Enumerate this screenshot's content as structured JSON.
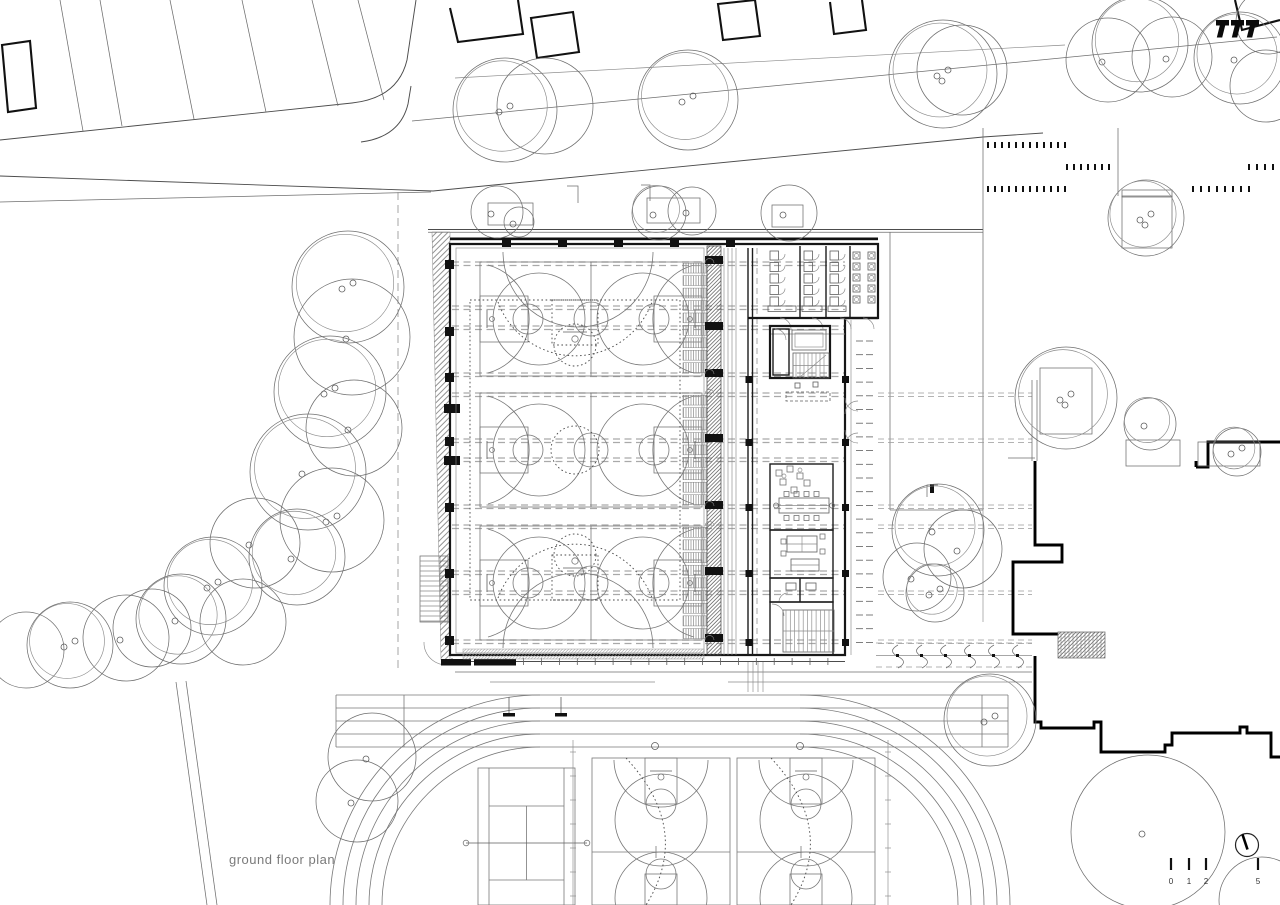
{
  "title": {
    "label": "ground floor plan"
  },
  "scale_bar": {
    "labels": [
      "0",
      "1",
      "2",
      "5"
    ],
    "unit_hint": "meters"
  },
  "compass": {
    "icon": "north-arrow"
  },
  "logo": {
    "icon": "architect-logo",
    "glyph_count": 3
  },
  "colors": {
    "paper": "#ffffff",
    "ink": "#1a1a1a",
    "ink_light": "#6e6e6e",
    "wall_poche": "#000000",
    "grid_dash": "#a9a9a9",
    "title_text": "#7a7a7a"
  },
  "plan": {
    "drawing_type": "architectural site plan",
    "level": "ground floor",
    "features": [
      "sports-hall",
      "indoor-basketball-courts",
      "show-court",
      "telescopic-bleachers",
      "changing-rooms",
      "sanitary-cubicles",
      "stair-and-lift-core",
      "reception-desk",
      "meeting-room",
      "office",
      "south-stair",
      "bicycle-racks",
      "athletics-track",
      "tennis-court",
      "outdoor-basketball-courts",
      "existing-school-building",
      "street-with-parking-bays",
      "parking-stall-markers",
      "trees",
      "tree-planters",
      "embankment",
      "external-stair"
    ]
  }
}
